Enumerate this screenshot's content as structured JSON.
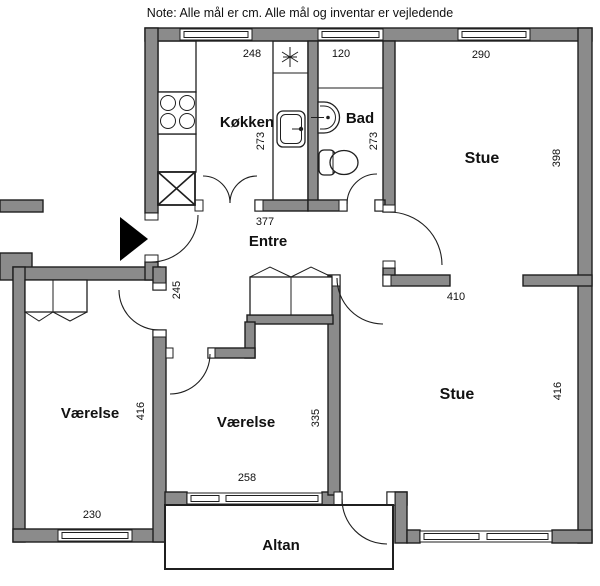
{
  "note": "Note: Alle mål er cm. Alle mål og inventar er vejledende",
  "colors": {
    "wall_fill": "#8b8b8b",
    "outline": "#1f1f1f",
    "background": "#ffffff",
    "entrance_arrow": "#000000"
  },
  "rooms": {
    "kitchen": {
      "label": "Køkken",
      "width_cm": "248",
      "height_cm": "273"
    },
    "bath": {
      "label": "Bad",
      "width_cm": "120",
      "height_cm": "273"
    },
    "living_top": {
      "label": "Stue",
      "width_cm": "290",
      "height_cm": "398"
    },
    "hall": {
      "label": "Entre",
      "width_cm": "377",
      "depth_cm": "245"
    },
    "room_left": {
      "label": "Værelse",
      "width_cm": "230",
      "height_cm": "416"
    },
    "room_mid": {
      "label": "Værelse",
      "width_cm": "258",
      "height_cm": "335"
    },
    "living_bottom": {
      "label": "Stue",
      "width_cm": "410",
      "height_cm": "416"
    },
    "balcony": {
      "label": "Altan"
    }
  },
  "fixtures": {
    "stove": "stove-icon",
    "kitchen_sink": "sink-icon",
    "ceiling_light": "light-star-icon",
    "shaft": "shaft-x-icon",
    "bath_washbasin": "washbasin-icon",
    "toilet": "toilet-icon",
    "entrance_marker": "entrance-arrow-icon",
    "wardrobes": "wardrobe-icon",
    "windows": "window-icon",
    "doors": "door-arc-icon"
  }
}
